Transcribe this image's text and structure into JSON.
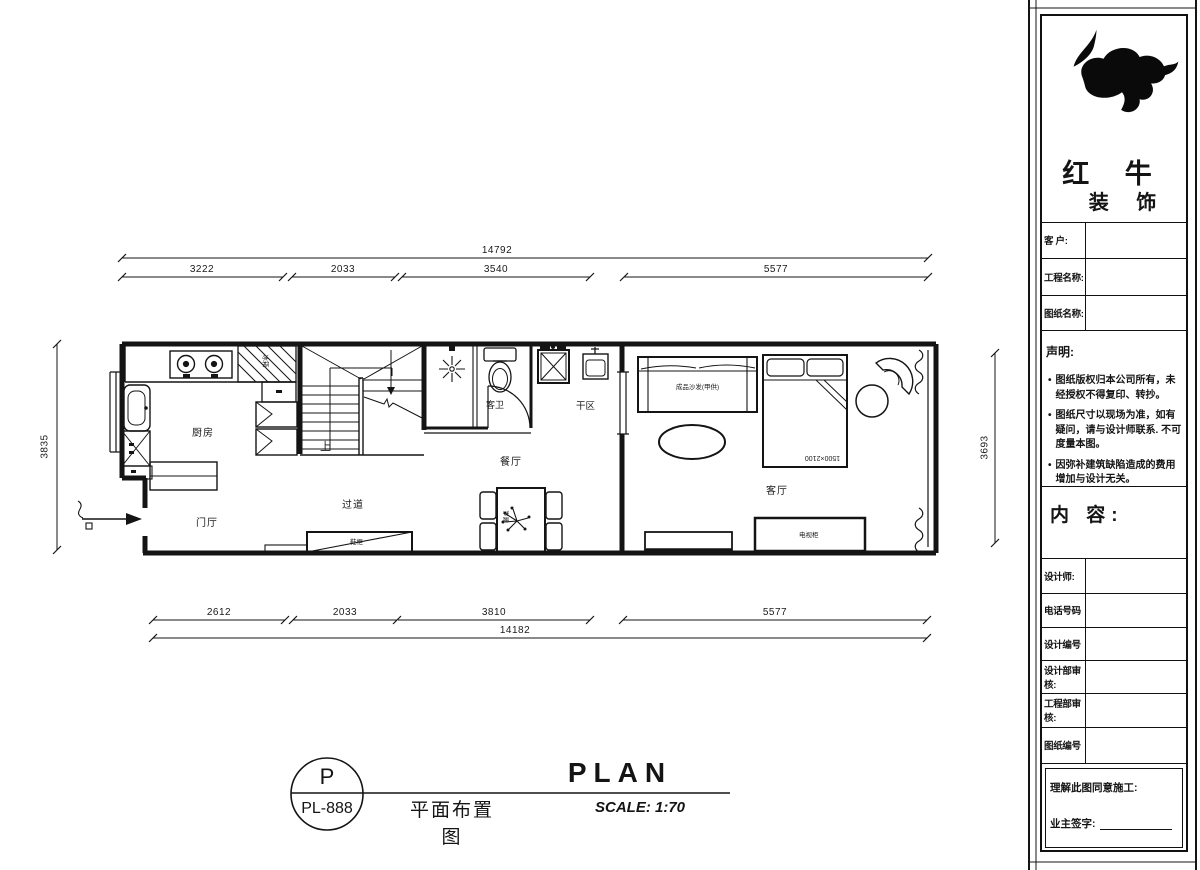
{
  "title_block": {
    "brand": {
      "line1": "红 牛",
      "line2": "装 饰"
    },
    "fields": [
      "客  户:",
      "工程名称:",
      "图纸名称:"
    ],
    "statement": {
      "title": "声明:",
      "items": [
        "图纸版权归本公司所有，未经授权不得复印、转抄。",
        "图纸尺寸以现场为准，如有疑问，请与设计师联系. 不可度量本图。",
        "因弥补建筑缺陷造成的费用增加与设计无关。"
      ]
    },
    "content_label": "内 容:",
    "rows": [
      "设计师:",
      "电话号码",
      "设计编号",
      "设计部审核:",
      "工程部审核:",
      "图纸编号"
    ],
    "footer": {
      "line1": "理解此图同意施工:",
      "line2": "业主签字:"
    }
  },
  "dimensions": {
    "top": {
      "total": "14792",
      "segments": [
        "3222",
        "2033",
        "3540",
        "5577"
      ]
    },
    "bottom": {
      "total": "14182",
      "segments": [
        "2612",
        "2033",
        "3810",
        "5577"
      ]
    },
    "left": "3835",
    "right": "3693"
  },
  "rooms": {
    "kitchen": "厨房",
    "foyer": "门厅",
    "corridor": "过道",
    "bathroom": "客卫",
    "dry_area": "干区",
    "dining": "餐厅",
    "living": "客厅"
  },
  "furniture": {
    "sofa": "成品沙发(甲供)",
    "bed_size": "1500×2100",
    "stairs_up": "上",
    "fridge": "冰箱",
    "corridor_cabinet": "鞋柜",
    "tv_cabinet": "电视柜",
    "dining_table": "餐桌"
  },
  "titlebar": {
    "code_top": "P",
    "code_bottom": "PL-888",
    "cn": "平面布置图",
    "en": "PLAN",
    "scale": "SCALE: 1:70"
  },
  "colors": {
    "ink": "#141414",
    "paper": "#ffffff"
  }
}
